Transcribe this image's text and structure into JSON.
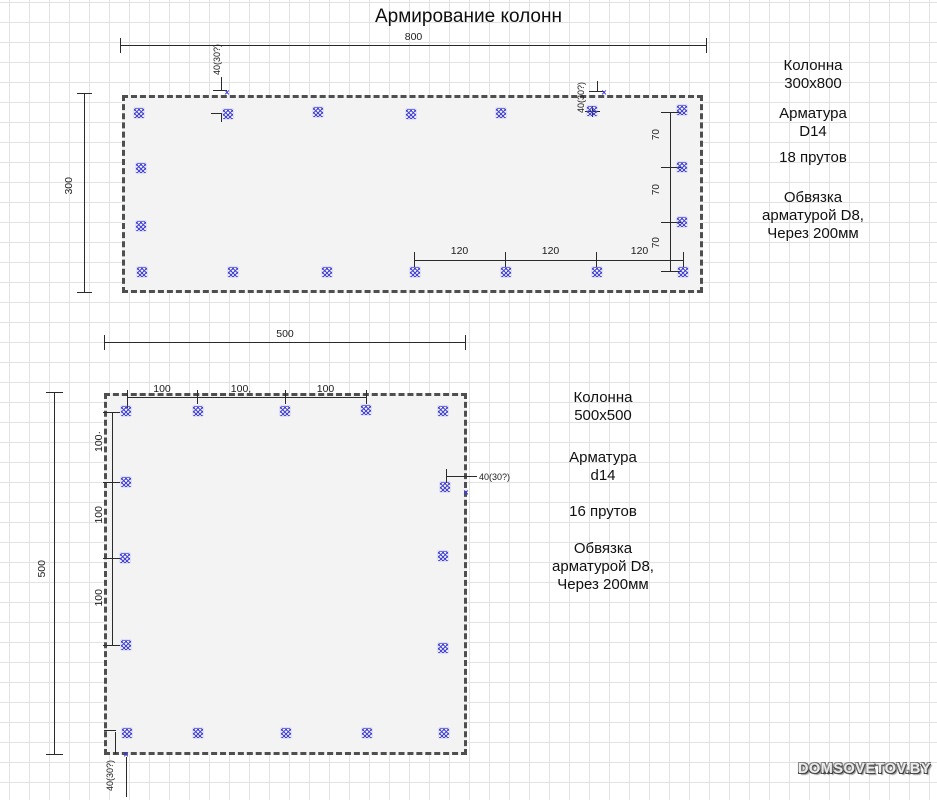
{
  "title": "Армирование колонн",
  "watermark": "DOMSOVETOV.BY",
  "colors": {
    "rebar_blue": "#3e3ed6",
    "line": "#2a2a2a",
    "panel_fill": "#f3f3f4",
    "panel_border": "#4f4f4f",
    "grid": "#e2e2e2"
  },
  "column1": {
    "dims": {
      "width": "800",
      "height": "300",
      "cover_left": "40(30?)",
      "cover_right": "40(30?)",
      "right_spacings": [
        "70",
        "70",
        "70"
      ],
      "bottom_spacings": [
        "120",
        "120",
        "120"
      ]
    },
    "marks": [
      [
        139,
        113
      ],
      [
        228,
        114
      ],
      [
        318,
        112
      ],
      [
        411,
        114
      ],
      [
        501,
        113
      ],
      [
        592,
        111
      ],
      [
        682,
        110
      ],
      [
        141,
        168
      ],
      [
        682,
        167
      ],
      [
        141,
        226
      ],
      [
        682,
        222
      ],
      [
        142,
        272
      ],
      [
        233,
        272
      ],
      [
        327,
        272
      ],
      [
        415,
        272
      ],
      [
        506,
        272
      ],
      [
        597,
        272
      ],
      [
        683,
        272
      ]
    ],
    "xmarks": [
      [
        227,
        93
      ],
      [
        604,
        93
      ]
    ],
    "info": {
      "name_lines": [
        "Колонна",
        "300х800"
      ],
      "rebar_lines": [
        "Арматура",
        "D14"
      ],
      "count": "18 прутов",
      "tie_lines": [
        "Обвязка",
        "арматурой D8,",
        "Через 200мм"
      ]
    }
  },
  "column2": {
    "dims": {
      "width": "500",
      "height": "500",
      "top_spacings": [
        "100",
        "100,",
        "100"
      ],
      "left_spacings": [
        "100·",
        "100",
        "100"
      ],
      "cover_right": "40(30?)",
      "cover_bottom": "40(30?)"
    },
    "marks": [
      [
        126,
        411
      ],
      [
        198,
        411
      ],
      [
        285,
        411
      ],
      [
        366,
        410
      ],
      [
        443,
        411
      ],
      [
        126,
        482
      ],
      [
        445,
        487
      ],
      [
        125,
        558
      ],
      [
        443,
        556
      ],
      [
        126,
        645
      ],
      [
        443,
        648
      ],
      [
        127,
        733
      ],
      [
        198,
        733
      ],
      [
        286,
        733
      ],
      [
        367,
        733
      ],
      [
        444,
        733
      ]
    ],
    "xmarks": [
      [
        126,
        755
      ],
      [
        466,
        493
      ]
    ],
    "info": {
      "name_lines": [
        "Колонна",
        "500х500"
      ],
      "rebar_lines": [
        "Арматура",
        "d14"
      ],
      "count": "16 прутов",
      "tie_lines": [
        "Обвязка",
        "арматурой D8,",
        "Через 200мм"
      ]
    }
  }
}
